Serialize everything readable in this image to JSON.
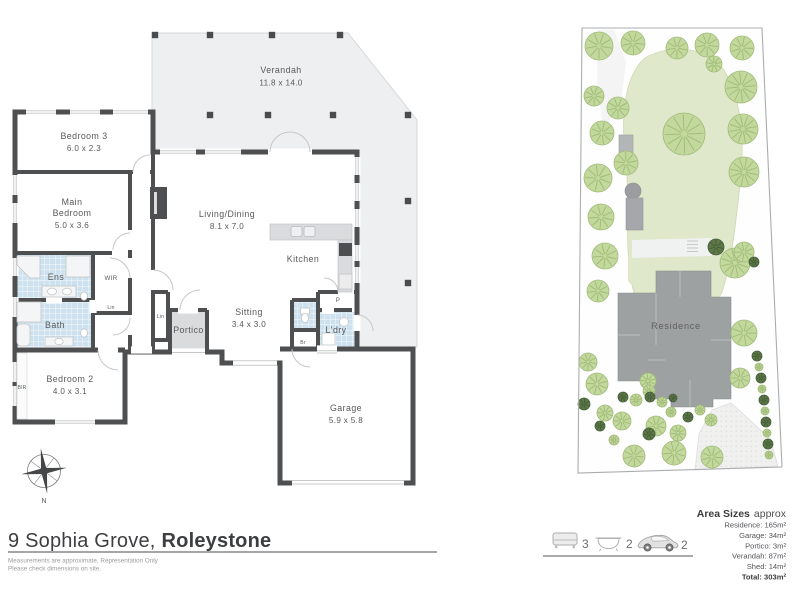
{
  "title": {
    "address": "9 Sophia Grove,",
    "suburb": "Roleystone"
  },
  "disclaimer": {
    "line1": "Measurements are approximate, Representation Only",
    "line2": "Please check dimensions on site."
  },
  "compass": {
    "north": "N"
  },
  "floorplan": {
    "verandah": {
      "name": "Verandah",
      "dims": "11.8 x 14.0"
    },
    "bedroom3": {
      "name": "Bedroom 3",
      "dims": "6.0 x 2.3"
    },
    "main_bedroom": {
      "l1": "Main",
      "l2": "Bedroom",
      "dims": "5.0 x 3.6"
    },
    "living": {
      "name": "Living/Dining",
      "dims": "8.1 x 7.0"
    },
    "kitchen": {
      "name": "Kitchen"
    },
    "ens": {
      "name": "Ens"
    },
    "wir": {
      "name": "WIR"
    },
    "lin_hall": {
      "name": "Lin"
    },
    "bath": {
      "name": "Bath"
    },
    "bedroom2": {
      "name": "Bedroom 2",
      "dims": "4.0 x 3.1"
    },
    "bir": {
      "name": "BIR"
    },
    "lin_entry": {
      "name": "Lin"
    },
    "portico": {
      "name": "Portico"
    },
    "sitting": {
      "name": "Sitting",
      "dims": "3.4 x 3.0"
    },
    "pantry": {
      "name": "P"
    },
    "broom": {
      "name": "Br"
    },
    "laundry": {
      "name": "L'dry"
    },
    "garage": {
      "name": "Garage",
      "dims": "5.9 x 5.8"
    }
  },
  "siteplan": {
    "residence_label": "Residence"
  },
  "features": {
    "beds": "3",
    "baths": "2",
    "cars": "2"
  },
  "areas": {
    "heading_bold": "Area Sizes",
    "heading_light": "approx",
    "rows": [
      "Residence: 165m²",
      "Garage: 34m²",
      "Portico: 3m²",
      "Verandah: 87m²",
      "Shed: 14m²",
      "Total: 303m²"
    ]
  }
}
